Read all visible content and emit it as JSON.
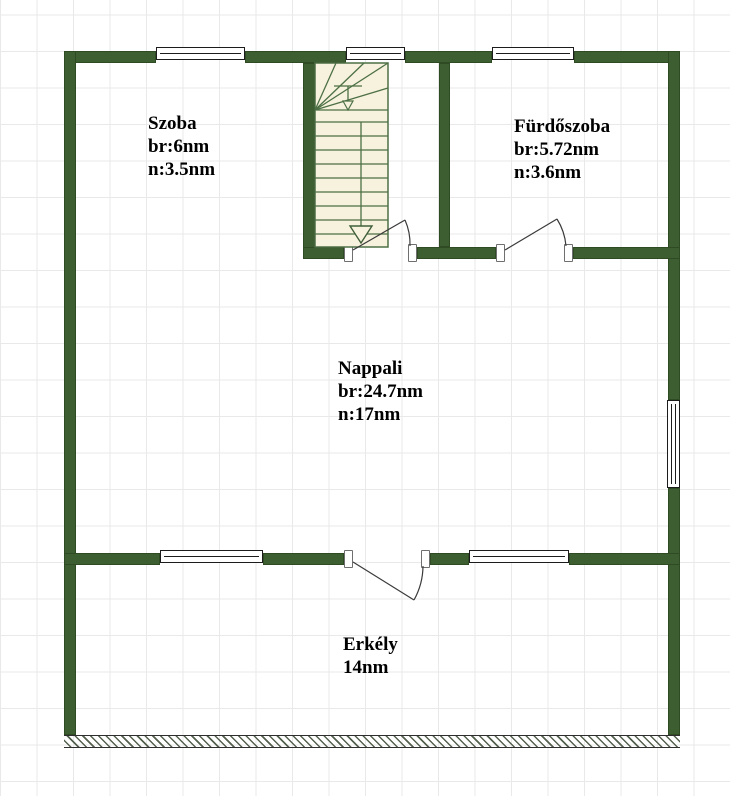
{
  "title": "Emeleti alaprajz",
  "colors": {
    "wall": "#3d5e30",
    "grid": "#e9e9e9",
    "stair_fill": "#f7f2de",
    "stair_line": "#4d7045",
    "ink": "#000000"
  },
  "rooms": [
    {
      "id": "szoba",
      "name": "Szoba",
      "gross": "br:6nm",
      "net": "n:3.5nm"
    },
    {
      "id": "furdoszoba",
      "name": "Fürdőszoba",
      "gross": "br:5.72nm",
      "net": "n:3.6nm"
    },
    {
      "id": "nappali",
      "name": "Nappali",
      "gross": "br:24.7nm",
      "net": "n:17nm"
    },
    {
      "id": "erkely",
      "name": "Erkély",
      "gross": "14nm"
    }
  ],
  "features": {
    "staircase": "winder staircase with down arrow",
    "doors": [
      "stair-room-door",
      "bathroom-door",
      "balcony-door"
    ],
    "windows_count": 6,
    "balcony_edge": "hatched open edge"
  }
}
